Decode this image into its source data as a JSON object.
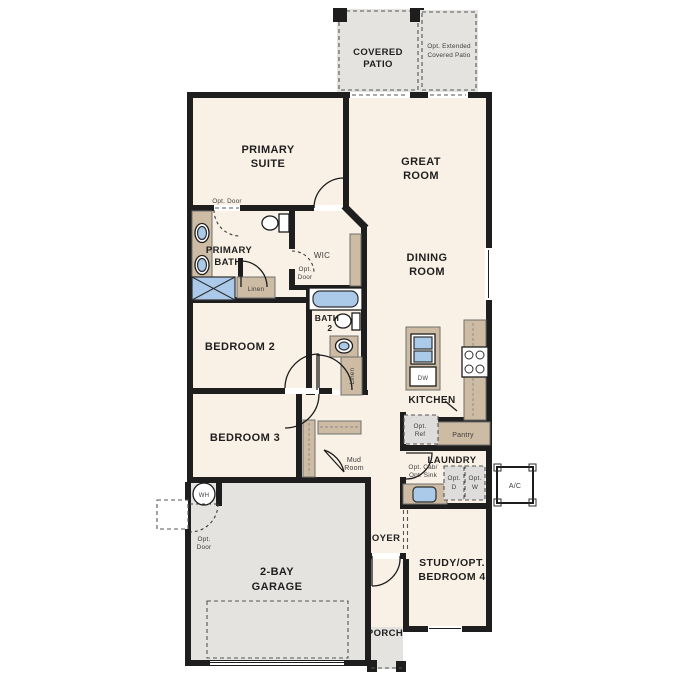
{
  "plan": {
    "colors": {
      "wall": "#1e1e1e",
      "room": "#faf1e6",
      "outdoor": "#e4e3e0",
      "cabinet": "#cdbba3",
      "fixture": "#abc9e8",
      "fixture_box": "#dedddb",
      "label": "#1f1f1f",
      "annotation": "#3d3d3d",
      "dash": "#555555"
    },
    "rooms": {
      "covered_patio": {
        "lines": [
          "COVERED",
          "PATIO"
        ]
      },
      "opt_extended_patio": {
        "lines": [
          "Opt. Extended",
          "Covered Patio"
        ]
      },
      "primary_suite": {
        "lines": [
          "PRIMARY",
          "SUITE"
        ]
      },
      "great_room": {
        "lines": [
          "GREAT",
          "ROOM"
        ]
      },
      "dining_room": {
        "lines": [
          "DINING",
          "ROOM"
        ]
      },
      "primary_bath": {
        "lines": [
          "PRIMARY",
          "BATH"
        ]
      },
      "wic": {
        "lines": [
          "WIC"
        ]
      },
      "bath_2": {
        "lines": [
          "BATH",
          "2"
        ]
      },
      "bedroom_2": {
        "lines": [
          "BEDROOM 2"
        ]
      },
      "bedroom_3": {
        "lines": [
          "BEDROOM 3"
        ]
      },
      "kitchen": {
        "lines": [
          "KITCHEN"
        ]
      },
      "laundry": {
        "lines": [
          "LAUNDRY"
        ]
      },
      "mud_room": {
        "lines": [
          "Mud",
          "Room"
        ]
      },
      "pantry": {
        "lines": [
          "Pantry"
        ]
      },
      "foyer": {
        "lines": [
          "FOYER"
        ]
      },
      "study": {
        "lines": [
          "STUDY/OPT.",
          "BEDROOM 4"
        ]
      },
      "garage": {
        "lines": [
          "2-BAY",
          "GARAGE"
        ]
      },
      "porch": {
        "lines": [
          "PORCH"
        ]
      }
    },
    "annotations": {
      "opt_door": "Opt. Door",
      "opt_door_lines": [
        "Opt.",
        "Door"
      ],
      "linen": "Linen",
      "opt_ref_lines": [
        "Opt.",
        "Ref"
      ],
      "opt_cab_sink_lines": [
        "Opt. Cab/",
        "Opt. Sink"
      ],
      "opt_dryer_lines": [
        "Opt.",
        "D"
      ],
      "opt_washer_lines": [
        "Opt.",
        "W"
      ],
      "ac": "A/C",
      "wh": "WH",
      "dw": "DW"
    }
  }
}
